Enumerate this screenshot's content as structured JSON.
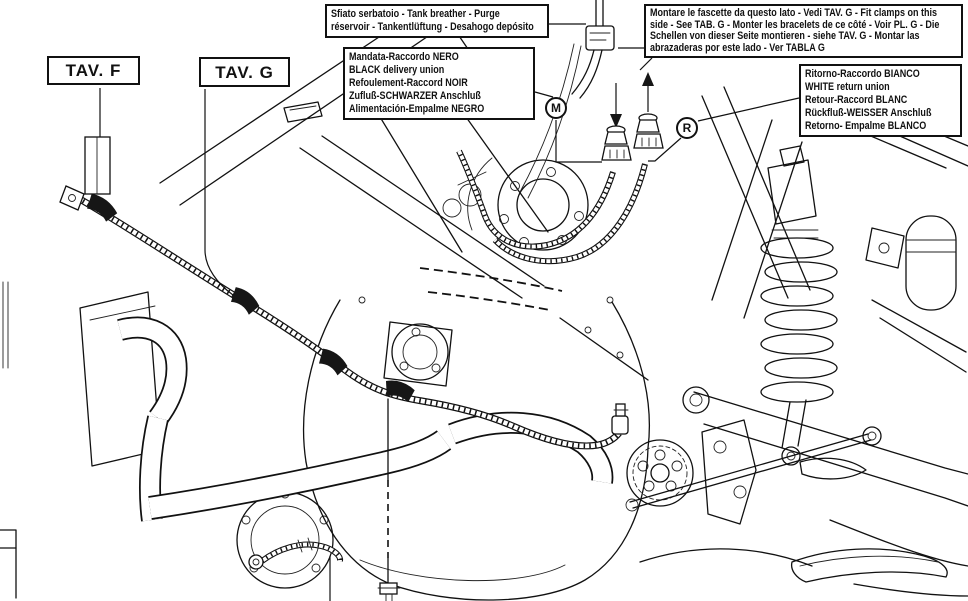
{
  "diagram": {
    "background_color": "#ffffff",
    "line_color": "#111111",
    "callouts": {
      "tank_breather": {
        "lines": [
          "Sfiato serbatoio - Tank breather - Purge",
          "réservoir - Tankentlüftung - Desahogo depósito"
        ]
      },
      "fit_clamps": {
        "text": "Montare le fascette da questo lato - Vedi TAV. G - Fit clamps on this side - See TAB. G - Monter les bracelets de ce côté - Voir PL. G - Die Schellen von dieser Seite montieren - siehe TAV. G - Montar las abrazaderas por este lado - Ver TABLA G"
      },
      "delivery_union": {
        "lines": [
          "Mandata-Raccordo NERO",
          "BLACK delivery union",
          "Refoulement-Raccord NOIR",
          "Zufluß-SCHWARZER Anschluß",
          "Alimentación-Empalme NEGRO"
        ]
      },
      "return_union": {
        "lines": [
          "Ritorno-Raccordo BIANCO",
          "WHITE return union",
          "Retour-Raccord BLANC",
          "Rückfluß-WEISSER Anschluß",
          "Retorno- Empalme BLANCO"
        ]
      },
      "tav_f": {
        "label": "TAV. F"
      },
      "tav_g": {
        "label": "TAV. G"
      },
      "marker_m": {
        "letter": "M"
      },
      "marker_r": {
        "letter": "R"
      }
    }
  }
}
